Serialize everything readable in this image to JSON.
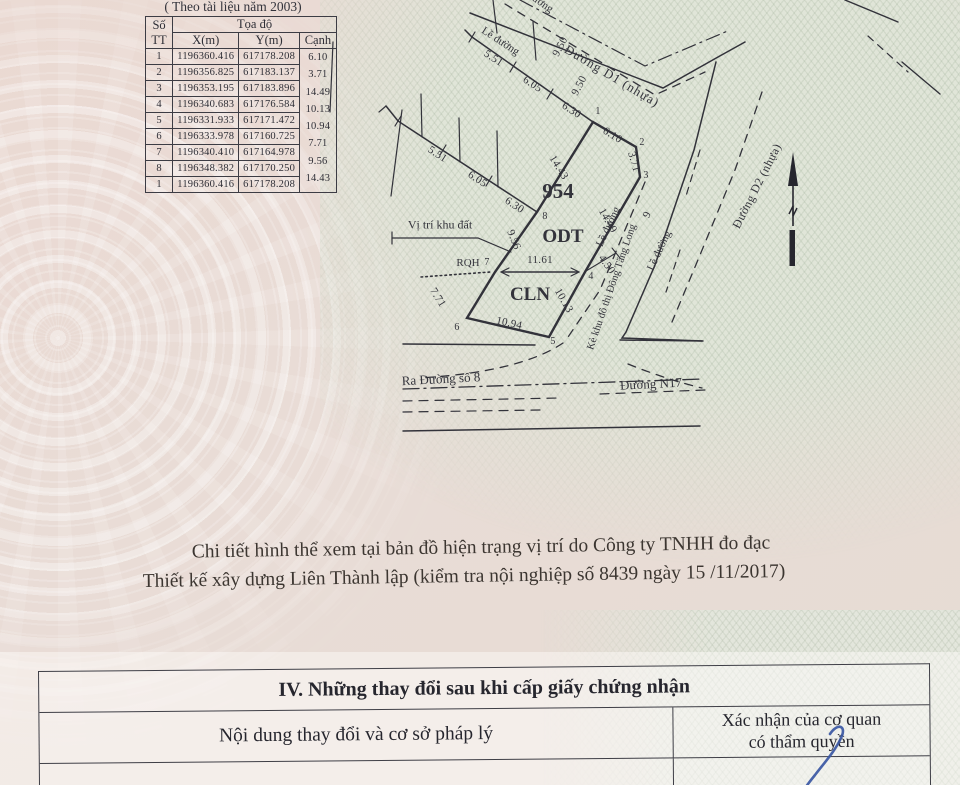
{
  "page": {
    "source_note": "( Theo tài liệu năm 2003)",
    "survey_note_line1": "Chi tiết hình thể xem tại bản đồ hiện trạng vị trí do Công ty TNHH đo đạc",
    "survey_note_line2": "Thiết kế xây dựng Liên Thành lập (kiểm tra nội nghiệp số 8439 ngày 15 /11/2017)"
  },
  "coord_table": {
    "header": {
      "stt1": "Số",
      "stt2": "TT",
      "toado": "Tọa độ",
      "x": "X(m)",
      "y": "Y(m)",
      "canh": "Cạnh"
    },
    "rows": [
      {
        "stt": "1",
        "x": "1196360.416",
        "y": "617178.208"
      },
      {
        "stt": "2",
        "x": "1196356.825",
        "y": "617183.137"
      },
      {
        "stt": "3",
        "x": "1196353.195",
        "y": "617183.896"
      },
      {
        "stt": "4",
        "x": "1196340.683",
        "y": "617176.584"
      },
      {
        "stt": "5",
        "x": "1196331.933",
        "y": "617171.472"
      },
      {
        "stt": "6",
        "x": "1196333.978",
        "y": "617160.725"
      },
      {
        "stt": "7",
        "x": "1196340.410",
        "y": "617164.978"
      },
      {
        "stt": "8",
        "x": "1196348.382",
        "y": "617170.250"
      },
      {
        "stt": "1",
        "x": "1196360.416",
        "y": "617178.208"
      }
    ],
    "edge_lengths": [
      "6.10",
      "3.71",
      "14.49",
      "10.13",
      "10.94",
      "7.71",
      "9.56",
      "14.43"
    ]
  },
  "map": {
    "parcel_number": "954",
    "zone_odt": "ODT",
    "zone_cln": "CLN",
    "vertices": [
      "1",
      "2",
      "3",
      "4",
      "5",
      "6",
      "7",
      "8"
    ],
    "edge_dims": [
      "6.10",
      "3.71",
      "14.49",
      "10.13",
      "10.94",
      "7.71",
      "9.56",
      "14.43"
    ],
    "split_dim": "11.61",
    "setback_dim": "4.50",
    "road_width": "9.50",
    "width_nine": "9",
    "alley_dims": [
      "5.51",
      "6.05",
      "6.30"
    ],
    "labels": {
      "site_pointer": "Vị trí khu đất",
      "rqh": "RQH",
      "road_edge": "Lề đường",
      "road_edge_cut": "đường",
      "road_d1": "Đường D1 (nhựa)",
      "road_d2": "Đường D2 (nhựa)",
      "embankment": "Kè khu đô thị Đông Tăng Long",
      "street8": "Ra Đường số 8",
      "n17": "Đường N17"
    }
  },
  "section_iv": {
    "title": "IV. Những thay đổi sau khi cấp giấy chứng nhận",
    "col_content": "Nội dung thay đổi và cơ sở pháp lý",
    "col_confirm_line1": "Xác nhận của cơ quan",
    "col_confirm_line2": "có thẩm quyền"
  }
}
